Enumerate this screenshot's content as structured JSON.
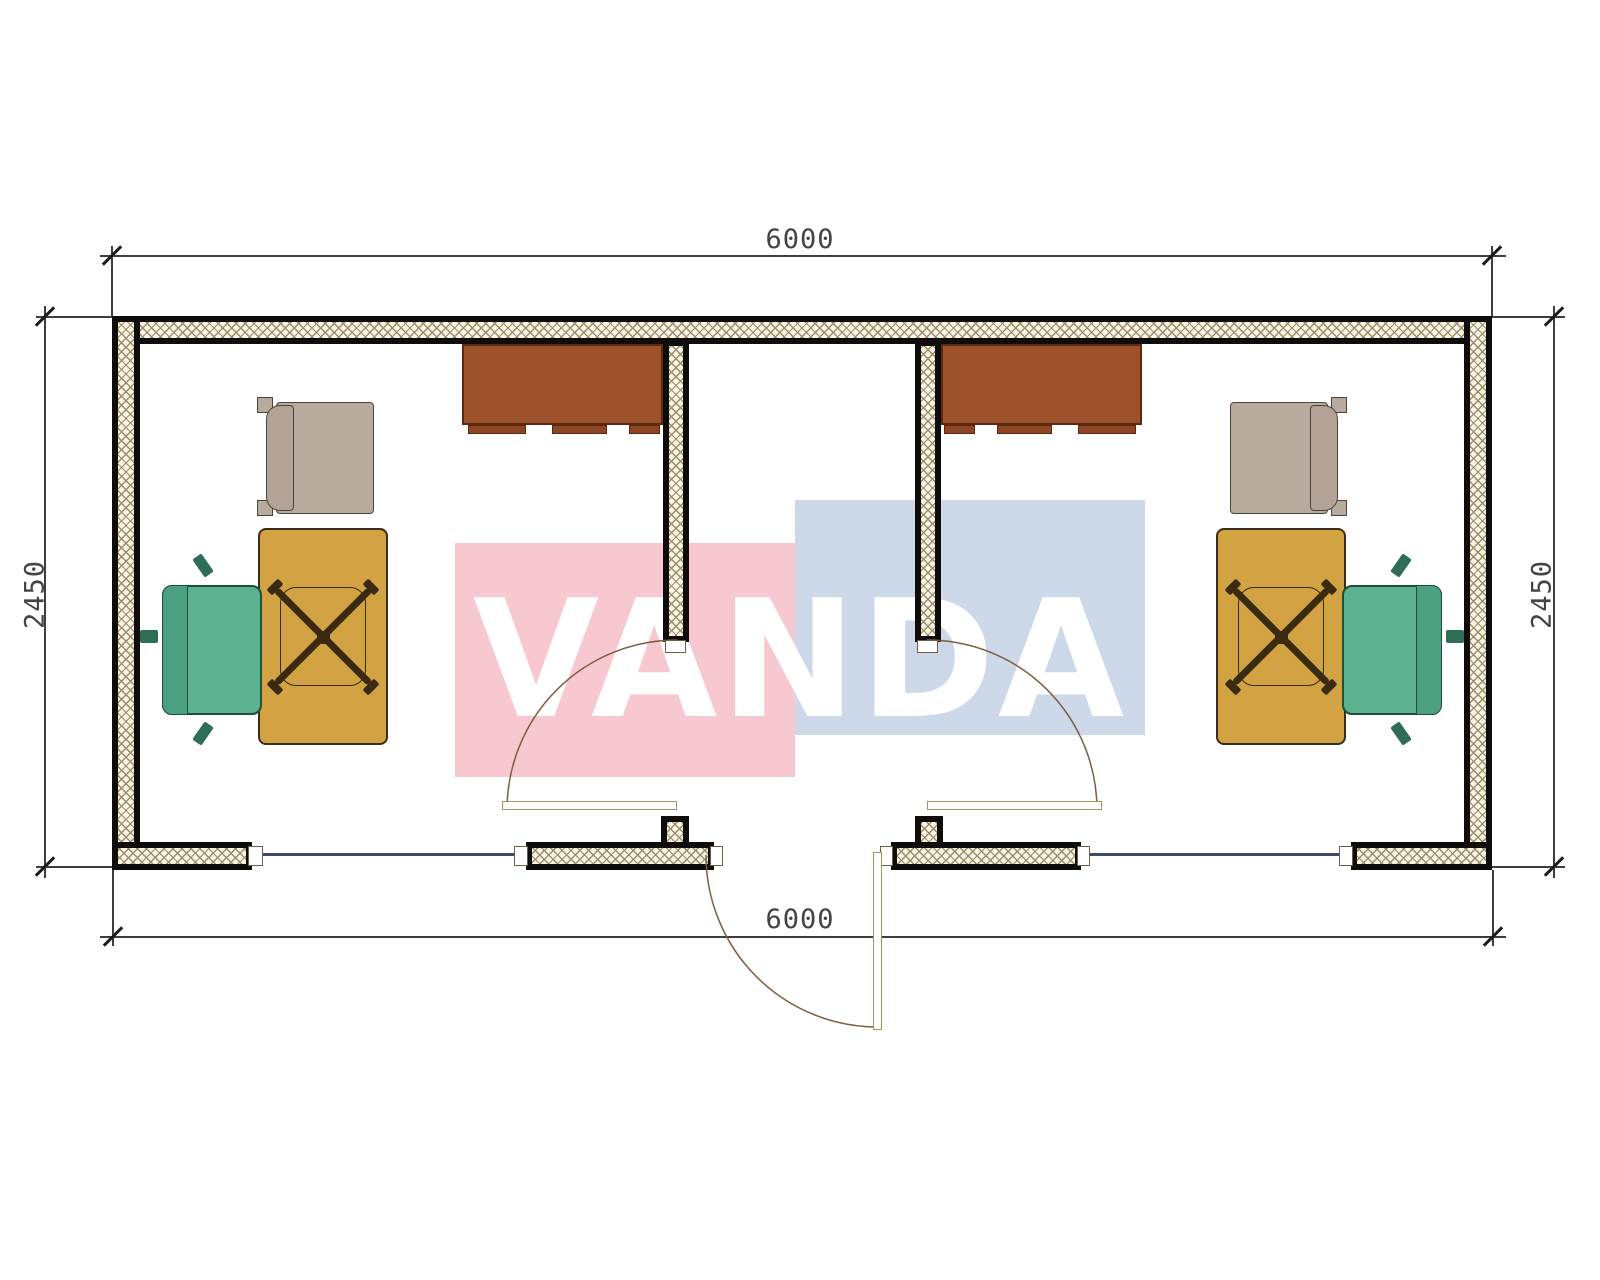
{
  "title": "Two-office container floor plan",
  "watermark": {
    "text": "VANDA",
    "red_block_color": "#f8c8d0",
    "blue_block_color": "#cdd9e9",
    "text_color": "#ffffff"
  },
  "dimensions": {
    "top": "6000",
    "bottom": "6000",
    "left": "2450",
    "right": "2450"
  },
  "plan": {
    "wall_fill_color": "#0e0d0b",
    "insulation_hatch_color": "#9a8c64",
    "window_color": "#3b4b68",
    "rooms": [
      {
        "name": "office-left",
        "furniture": [
          "wall-cabinet",
          "guest-armchair",
          "desk",
          "office-chair"
        ]
      },
      {
        "name": "entrance-hall",
        "furniture": []
      },
      {
        "name": "office-right",
        "furniture": [
          "wall-cabinet",
          "guest-armchair",
          "desk",
          "office-chair"
        ]
      }
    ],
    "doors": [
      "entrance-door",
      "interior-door-left",
      "interior-door-right"
    ],
    "windows": 2,
    "furniture_colors": {
      "desk": "#d2a243",
      "cabinet": "#9c512b",
      "office_chair": "#5cb191",
      "guest_armchair": "#b8aa9d"
    }
  }
}
